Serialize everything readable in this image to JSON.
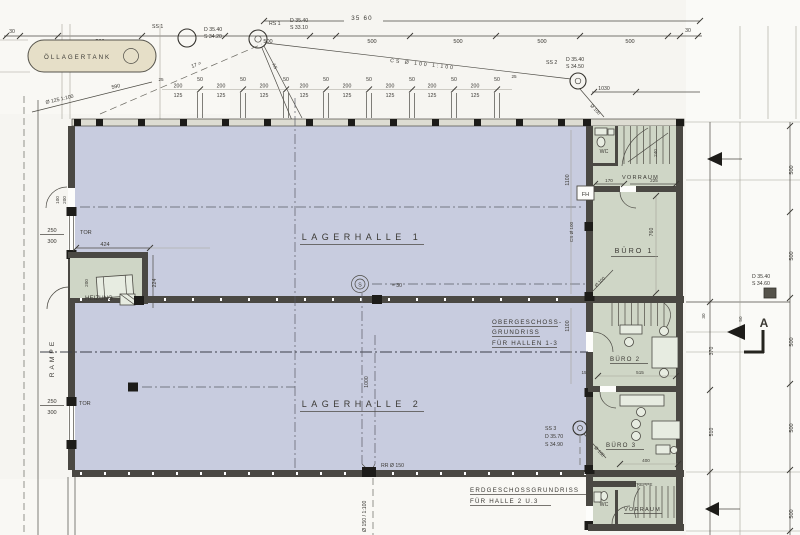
{
  "colors": {
    "hall_fill": "#c8ccdf",
    "office_fill": "#cfd6c6",
    "tank_fill": "#e6dfc8",
    "wall": "#4a4843",
    "ink": "#3b3934",
    "paper": "#f6f5f1"
  },
  "sheet": {
    "rooms": {
      "hall1": "LAGERHALLE 1",
      "hall2": "LAGERHALLE 2",
      "buero1": "BÜRO 1",
      "buero2": "BÜRO 2",
      "buero3": "BÜRO 3",
      "heizung": "HEIZUNG",
      "wc": "WC",
      "vorraum": "VORRAUM",
      "treppe": "TREPPE",
      "rampe": "RAMPE",
      "tank": "ÖLLAGERTANK",
      "tor": "TOR"
    },
    "captions": {
      "og1": "OBERGESCHOSS-",
      "og2": "GRUNDRISS",
      "og3": "FÜR HALLEN 1-3",
      "eg1": "ERDGESCHOSSGRUNDRISS",
      "eg2": "FÜR HALLE 2 U.3"
    },
    "shafts": {
      "ss1_label": "SS 1",
      "ss1_d": "D 35.40",
      "ss1_s": "S 34.20",
      "rs1_label": "RS 1",
      "rs1_d": "D 35.40",
      "rs1_s": "S 33.10",
      "ss2_label": "SS 2",
      "ss2_d": "D 35.40",
      "ss2_s": "S 34.50",
      "ss3_label": "SS 3",
      "ss3_d": "D 35.70",
      "ss3_s": "S 34.90",
      "hd_d": "D 35.40",
      "hd_s": "S 34.60",
      "s_mark": "S",
      "s_note": "≈ 30",
      "fh": "FH",
      "rr": "RR Ø 150",
      "fall_rr": "Ø 150 / 1:100",
      "cs_roof": "CS Ø 100  1:100",
      "cs_wall": "CS Ø 100",
      "o100": "Ø 100",
      "o125": "Ø 125  1:100",
      "n590": "590",
      "n17": "17 =",
      "as_mark": "AS",
      "section_a": "A"
    },
    "dims": {
      "total_w": "35 60",
      "d30": "30",
      "d500": "500",
      "d25": "25",
      "d50": "50",
      "d200": "200",
      "d125": "125",
      "d1030": "1030",
      "d100": "100",
      "d200b": "200",
      "d250": "250",
      "d300": "300",
      "d424": "424",
      "d224": "224",
      "d1000": "1000",
      "d1100": "1100",
      "d170": "170",
      "d225": "225",
      "d240": "240",
      "d760": "760",
      "d515": "515",
      "d15": "15",
      "d400": "400",
      "d510": "510",
      "d370": "370"
    }
  }
}
